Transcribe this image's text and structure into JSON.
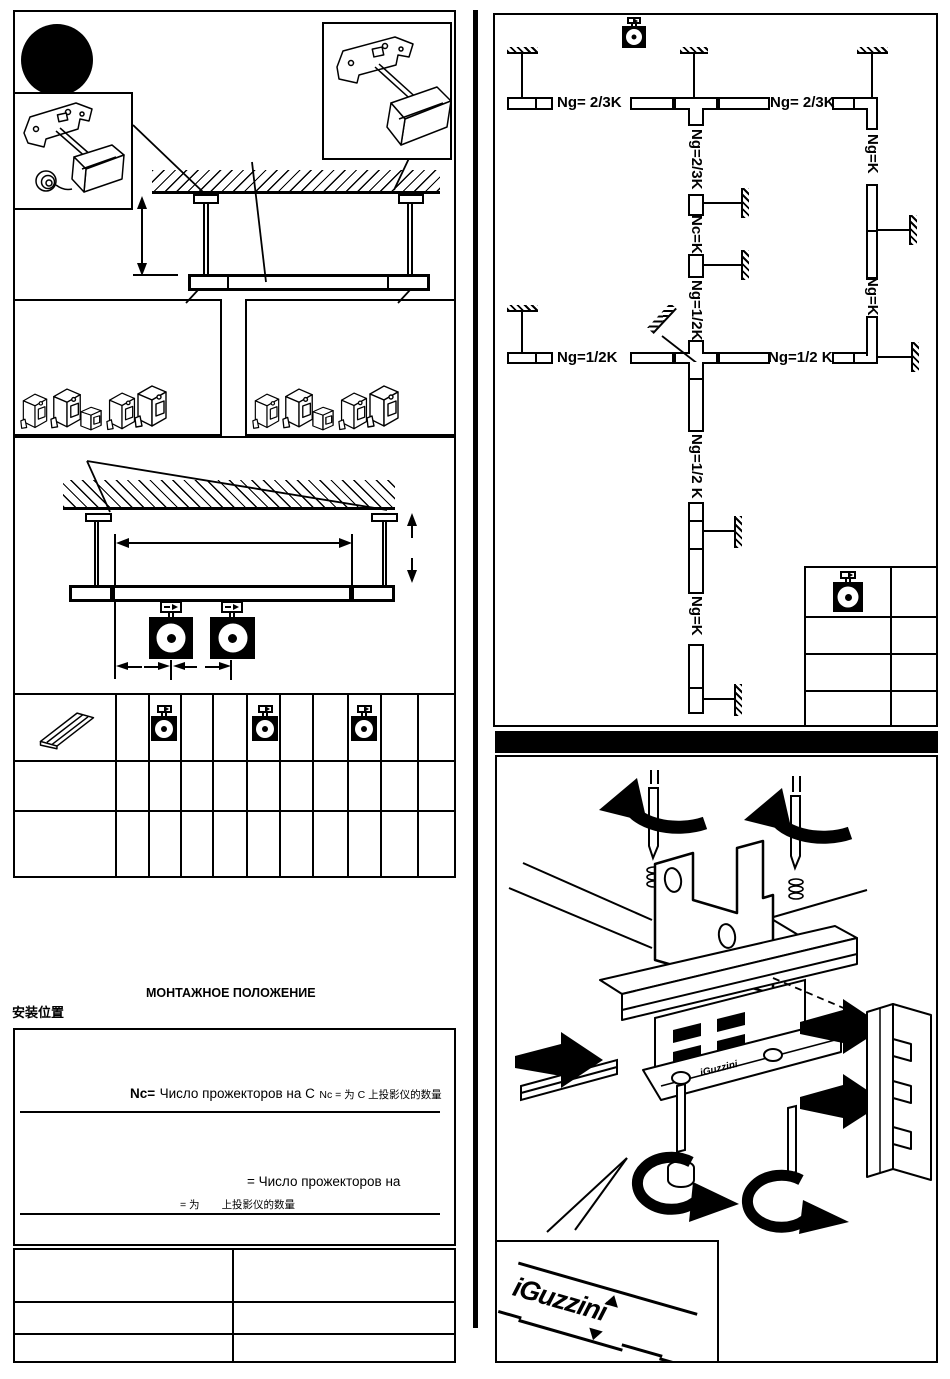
{
  "page": {
    "paper_color": "#ffffff",
    "ink_color": "#000000"
  },
  "left_column": {
    "mounting_title_ru": "МОНТАЖНОЕ ПОЛОЖЕНИЕ",
    "mounting_title_zh": "安装位置",
    "formulas": {
      "nc_label": "Nc=",
      "nc_ru": "Число прожекторов на C",
      "nc_zh": "Nc = 为 C 上投影仪的数量",
      "n_ru": "= Число прожекторов на",
      "n_zh_eq": "= 为",
      "n_zh_rest": "上投影仪的数量"
    }
  },
  "track_plan": {
    "labels": {
      "top_left": "Ng= 2/3K",
      "top_right": "Ng= 2/3K",
      "center_vertical_top": "Ng=2/3K",
      "center_vertical_mid": "Nc=K",
      "center_vertical_low": "Ng=1/2K",
      "right_vertical_top": "Ng=K",
      "right_vertical_low": "Ng=K",
      "middle_left": "Ng=1/2K",
      "middle_right": "Ng=1/2 K",
      "below_cross_top": "Ng=1/2 K",
      "below_cross_bottom": "Ng=K"
    }
  },
  "brand": {
    "logo_text": "iGuzzini"
  },
  "icons": {
    "step_dot": "filled-black-circle",
    "projector_symbol": "black-square-with-lens-circle",
    "ceiling_anchor": "hatched-ground-bar",
    "track_adapter": "small-rect-with-arrow",
    "channel_profile": "isometric-channel-rail",
    "mounting_clamp": "isometric-clamp-block",
    "rotation_arrow": "thick-curved-arrow",
    "insertion_arrow": "solid-block-arrow"
  }
}
